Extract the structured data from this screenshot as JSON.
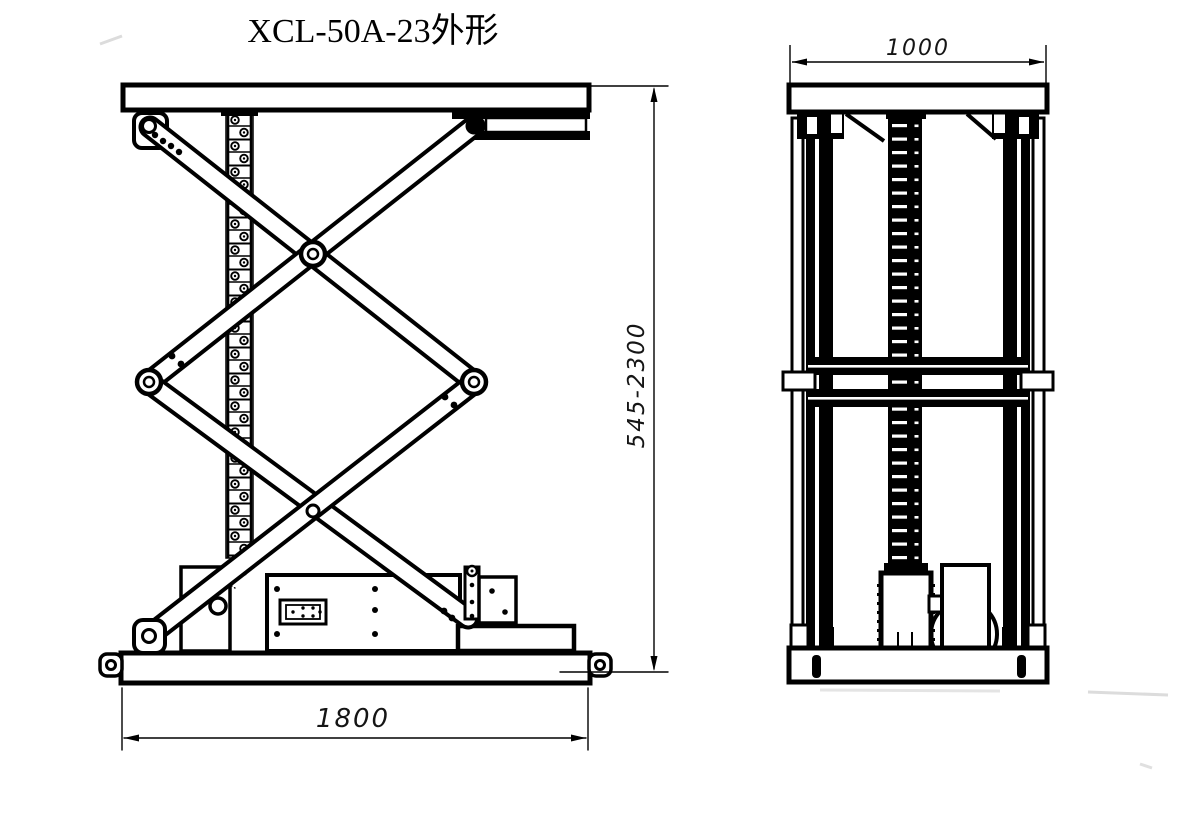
{
  "drawing": {
    "title": "XCL-50A-23外形",
    "dimensions": {
      "side_width": "1800",
      "side_height": "545-2300",
      "front_width": "1000"
    },
    "colors": {
      "line": "#000000",
      "background": "#ffffff",
      "dim_text": "#151515"
    }
  }
}
